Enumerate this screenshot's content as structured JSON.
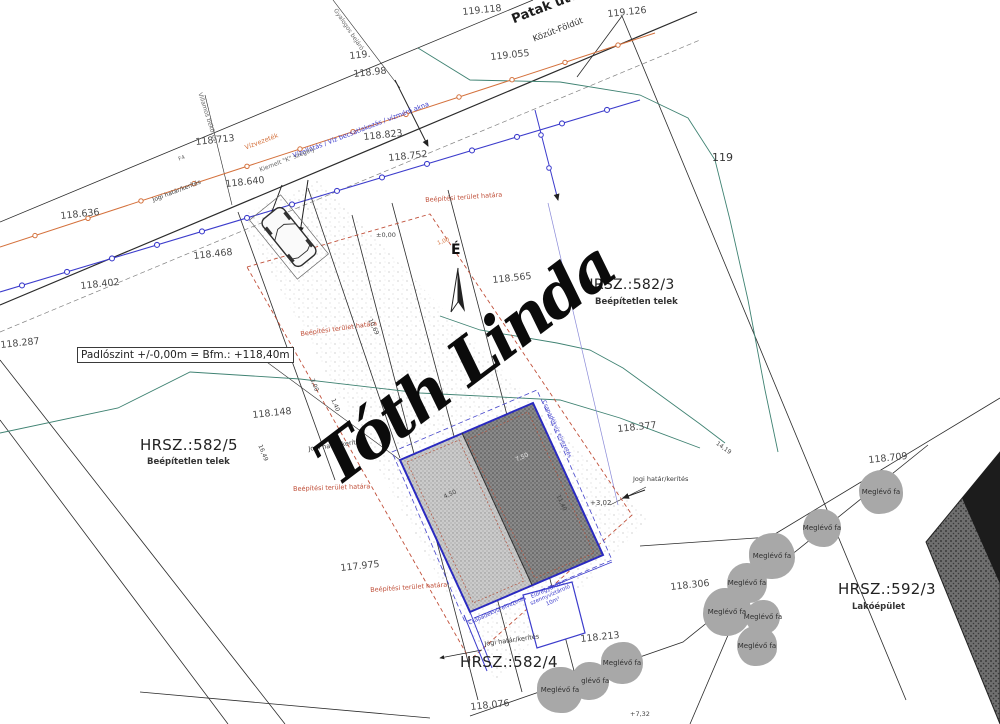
{
  "street": {
    "name": "Patak utca",
    "classification": "Közút-Földút"
  },
  "north_symbol": "É",
  "note_box": {
    "text": "Padlószint +/-0,00m = Bfm.: +118,40m"
  },
  "signature": {
    "text": "Tóth Linda"
  },
  "parcels": {
    "p582_5": {
      "id": "HRSZ.:582/5",
      "status": "Beépítetlen telek"
    },
    "p582_3": {
      "id": "HRSZ.:582/3",
      "status": "Beépítetlen telek"
    },
    "p582_4": {
      "id": "HRSZ.:582/4"
    },
    "p592_3": {
      "id": "HRSZ.:592/3",
      "status": "Lakóépület"
    },
    "p119": {
      "id": "119"
    }
  },
  "elevations": [
    "119.118",
    "119.126",
    "119.055",
    "119.",
    "118.98",
    "118.713",
    "118.823",
    "118.752",
    "118.640",
    "118.636",
    "118.468",
    "118.402",
    "118.287",
    "118.565",
    "118.377",
    "118.148",
    "117.975",
    "118.709",
    "118.306",
    "118.213",
    "118.076"
  ],
  "boundary_labels": {
    "legal_fence": "Jogi határ/kerítés",
    "building_area": "Beépítési terület határa",
    "curb": "Kiemelt \"K\" szegély",
    "water_main": "Vízvezeték",
    "water_service": "Vízellátás / Víz becsatlakozás / vízmérő akna",
    "pedestrian": "Gyalogos bejáró",
    "electric": "Villamos bekötés",
    "road_mark": "F4"
  },
  "tree_label": "Meglévő fa",
  "tank_label": {
    "l1": "Előregyártott",
    "l2": "szennyvíztároló",
    "l3": "10m³"
  },
  "drain_label": "Csapadékvíz elvezetés",
  "dims": {
    "d100": "1,00",
    "d300": "3,00",
    "d140": "1,40",
    "d1649": "16,49",
    "d1069": "10,69",
    "d1140": "11,40",
    "d450": "4,50",
    "d750": "7,50",
    "d1419": "14,19",
    "p302": "+3,02",
    "p000": "±0,00",
    "p732": "+7,32"
  },
  "colors": {
    "contour_green": "#3f8272",
    "utility_orange": "#d4713c",
    "utility_blue": "#3c3ccc",
    "boundary_red": "#c0503a",
    "building_light": "#cccccc",
    "building_dark": "#8a8a8a",
    "tree_gray": "#a8a8a8"
  }
}
